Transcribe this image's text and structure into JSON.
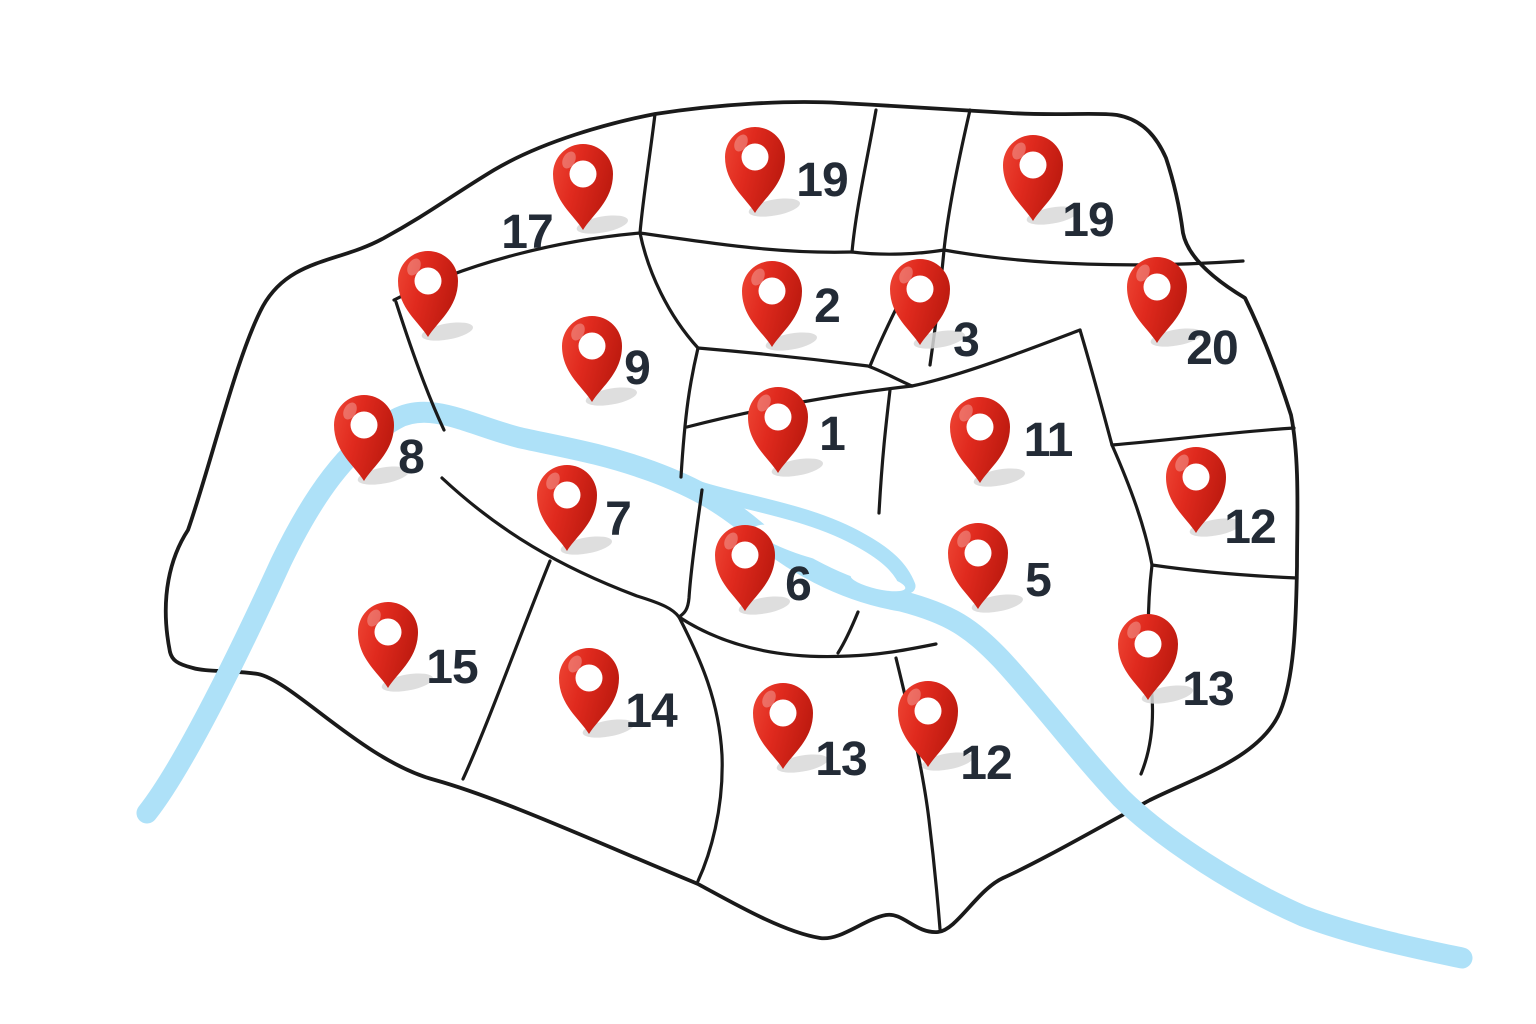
{
  "map": {
    "colors": {
      "background": "#ffffff",
      "outline_black": "#1a1a1a",
      "river_blue": "#aee1f8",
      "pin_red_light": "#ee4534",
      "pin_red": "#e02a1e",
      "pin_red_dark": "#bf1b10",
      "pin_hole_white": "#ffffff",
      "shadow_gray": "#d8d8d8",
      "label_dark": "#232b36"
    },
    "pins": [
      {
        "label": "17",
        "x": 583,
        "y": 230,
        "label_x": 527,
        "label_y": 248
      },
      {
        "label": "19",
        "x": 755,
        "y": 213,
        "label_x": 822,
        "label_y": 196
      },
      {
        "label": "19",
        "x": 1033,
        "y": 221,
        "label_x": 1088,
        "label_y": 236
      },
      {
        "label": "",
        "x": 428,
        "y": 337,
        "label_x": null,
        "label_y": null
      },
      {
        "label": "2",
        "x": 772,
        "y": 347,
        "label_x": 827,
        "label_y": 322
      },
      {
        "label": "3",
        "x": 920,
        "y": 345,
        "label_x": 966,
        "label_y": 356
      },
      {
        "label": "20",
        "x": 1157,
        "y": 343,
        "label_x": 1212,
        "label_y": 364
      },
      {
        "label": "9",
        "x": 592,
        "y": 402,
        "label_x": 637,
        "label_y": 384
      },
      {
        "label": "8",
        "x": 364,
        "y": 481,
        "label_x": 411,
        "label_y": 473
      },
      {
        "label": "1",
        "x": 778,
        "y": 473,
        "label_x": 832,
        "label_y": 450
      },
      {
        "label": "11",
        "x": 980,
        "y": 483,
        "label_x": 1048,
        "label_y": 456
      },
      {
        "label": "12",
        "x": 1196,
        "y": 533,
        "label_x": 1250,
        "label_y": 543
      },
      {
        "label": "7",
        "x": 567,
        "y": 551,
        "label_x": 618,
        "label_y": 535
      },
      {
        "label": "6",
        "x": 745,
        "y": 611,
        "label_x": 798,
        "label_y": 600
      },
      {
        "label": "5",
        "x": 978,
        "y": 609,
        "label_x": 1038,
        "label_y": 596
      },
      {
        "label": "15",
        "x": 388,
        "y": 688,
        "label_x": 452,
        "label_y": 683
      },
      {
        "label": "13",
        "x": 1148,
        "y": 700,
        "label_x": 1208,
        "label_y": 705
      },
      {
        "label": "14",
        "x": 589,
        "y": 734,
        "label_x": 651,
        "label_y": 727
      },
      {
        "label": "13",
        "x": 783,
        "y": 769,
        "label_x": 841,
        "label_y": 775
      },
      {
        "label": "12",
        "x": 928,
        "y": 767,
        "label_x": 986,
        "label_y": 779
      }
    ]
  }
}
